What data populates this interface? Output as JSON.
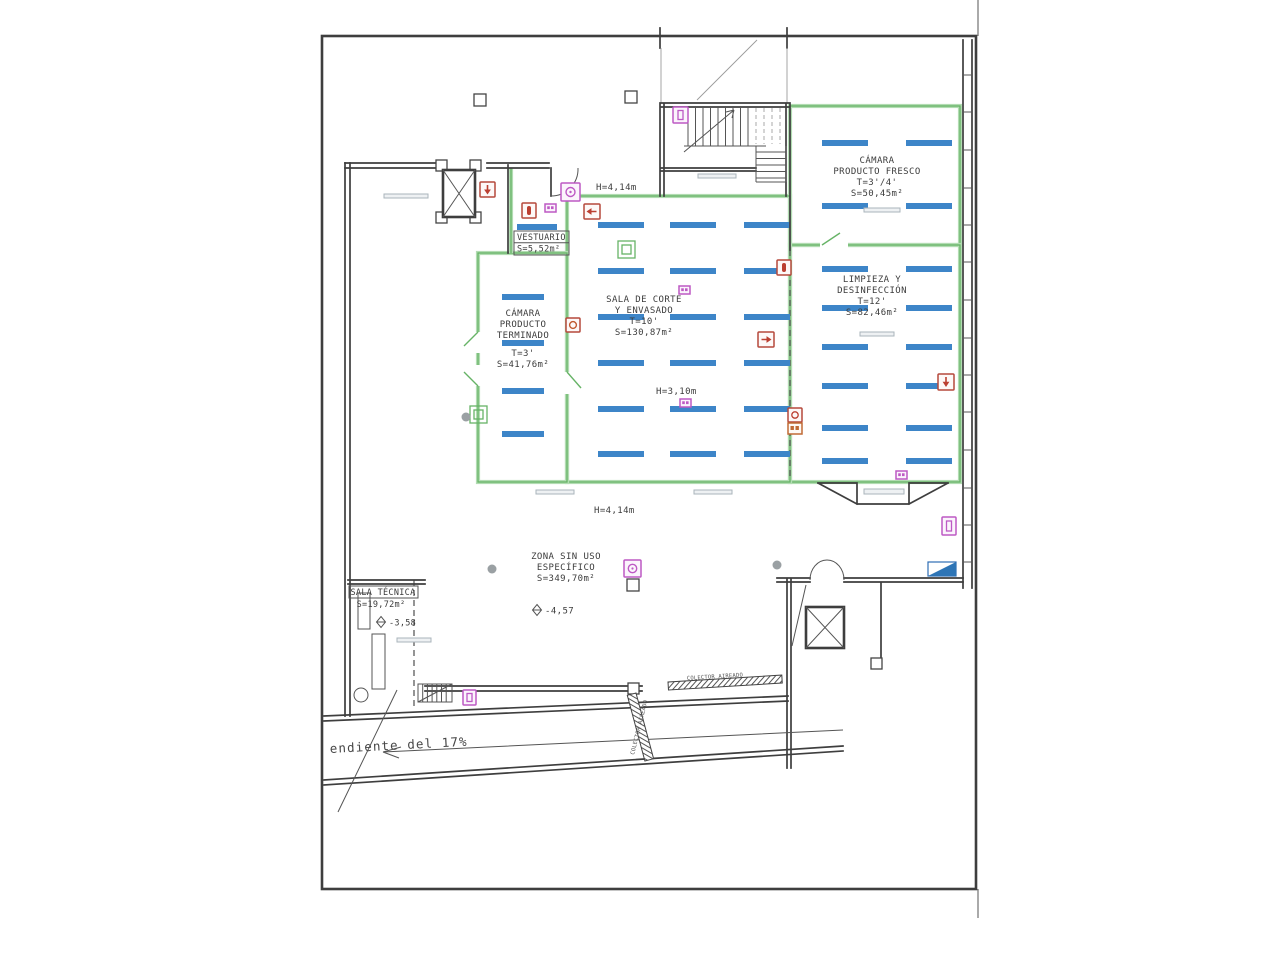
{
  "plan": {
    "rooms": {
      "fresco": {
        "l1": "CÁMARA",
        "l2": "PRODUCTO FRESCO",
        "l3": "T=3'/4'",
        "l4": "S=50,45m²"
      },
      "limpieza": {
        "l1": "LIMPIEZA Y",
        "l2": "DESINFECCIÓN",
        "l3": "T=12'",
        "l4": "S=82,46m²"
      },
      "corte": {
        "l1": "SALA DE CORTE",
        "l2": "Y ENVASADO",
        "l3": "T=10'",
        "l4": "S=130,87m²"
      },
      "terminado": {
        "l1": "CÁMARA",
        "l2": "PRODUCTO",
        "l3": "TERMINADO",
        "l4": "T=3'",
        "l5": "S=41,76m²"
      },
      "vestuario": {
        "l1": "VESTUARIO",
        "l2": "S=5,52m²"
      },
      "zona": {
        "l1": "ZONA SIN USO",
        "l2": "ESPECÍFICO",
        "l3": "S=349,70m²"
      },
      "tecnica": {
        "l1": "SALA TÉCNICA",
        "l2": "S=19,72m²"
      }
    },
    "dims": {
      "h_top": "H=4,14m",
      "h_mid": "H=3,10m",
      "h_low": "H=4,14m"
    },
    "levels": {
      "zona": "-4,57",
      "tecnica": "-3,58"
    },
    "notes": {
      "ramp": "endiente del 17%",
      "collector_h": "COLECTOR AIREADO",
      "collector_v": "COLECTOR AIREADO"
    }
  },
  "racks": {
    "bar_h": 6,
    "groups": [
      {
        "room": "fresco",
        "cols": [
          822,
          906
        ],
        "rows": [
          140,
          203
        ],
        "w": 46
      },
      {
        "room": "limpieza",
        "cols": [
          822,
          906
        ],
        "rows": [
          266,
          305,
          344,
          383,
          425,
          458
        ],
        "w": 46
      },
      {
        "room": "corte",
        "cols": [
          598,
          670,
          744
        ],
        "rows": [
          222,
          268,
          314,
          360,
          406,
          451
        ],
        "w": 46
      },
      {
        "room": "terminado",
        "cols": [
          502
        ],
        "rows": [
          294,
          340,
          388,
          431
        ],
        "w": 42
      },
      {
        "room": "vestuario",
        "cols": [
          517
        ],
        "rows": [
          224
        ],
        "w": 40
      }
    ]
  },
  "colors": {
    "rack_blue": "#3d85c8",
    "wall": "#3e3e3e",
    "partition_green": "#66b366",
    "signal_red": "#b5493c",
    "signal_magenta": "#bd59c4",
    "sign_blue": "#2e6db4"
  }
}
